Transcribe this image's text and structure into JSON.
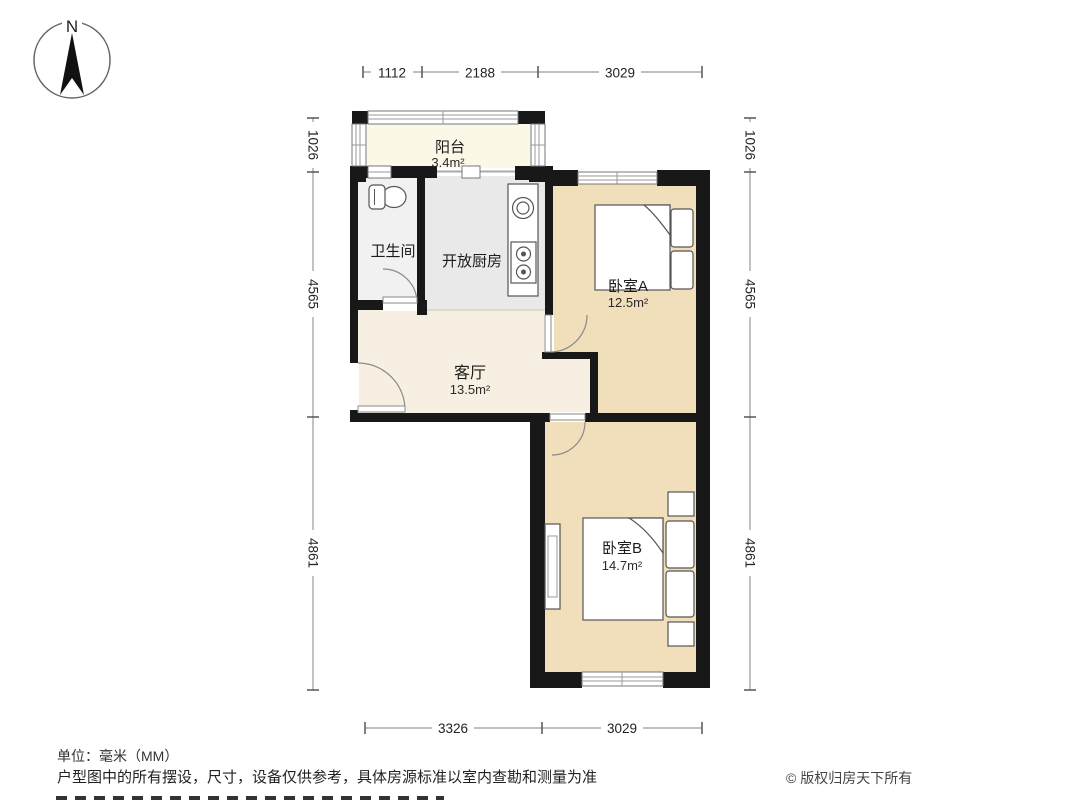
{
  "compass": {
    "label": "N"
  },
  "rooms": {
    "balcony": {
      "name": "阳台",
      "area": "3.4m²"
    },
    "bathroom": {
      "name": "卫生间"
    },
    "kitchen": {
      "name": "开放厨房"
    },
    "living": {
      "name": "客厅",
      "area": "13.5m²"
    },
    "bedroomA": {
      "name": "卧室A",
      "area": "12.5m²"
    },
    "bedroomB": {
      "name": "卧室B",
      "area": "14.7m²"
    }
  },
  "dimensions": {
    "top": [
      "1112",
      "2188",
      "3029"
    ],
    "bottom": [
      "3326",
      "3029"
    ],
    "left": [
      "1026",
      "4565",
      "4861"
    ],
    "right": [
      "1026",
      "4565",
      "4861"
    ]
  },
  "footer": {
    "unit": "单位：毫米（MM）",
    "disclaimer": "户型图中的所有摆设，尺寸，设备仅供参考，具体房源标准以室内查勘和测量为准",
    "copyright": "© 版权归房天下所有"
  },
  "colors": {
    "wall": "#181818",
    "bedroom_floor": "#f1deba",
    "living_floor": "#f7efe1",
    "kitchen_floor": "#e9e9e9",
    "bathroom_floor": "#f1f1f1",
    "balcony_floor": "#fbf8e8"
  }
}
